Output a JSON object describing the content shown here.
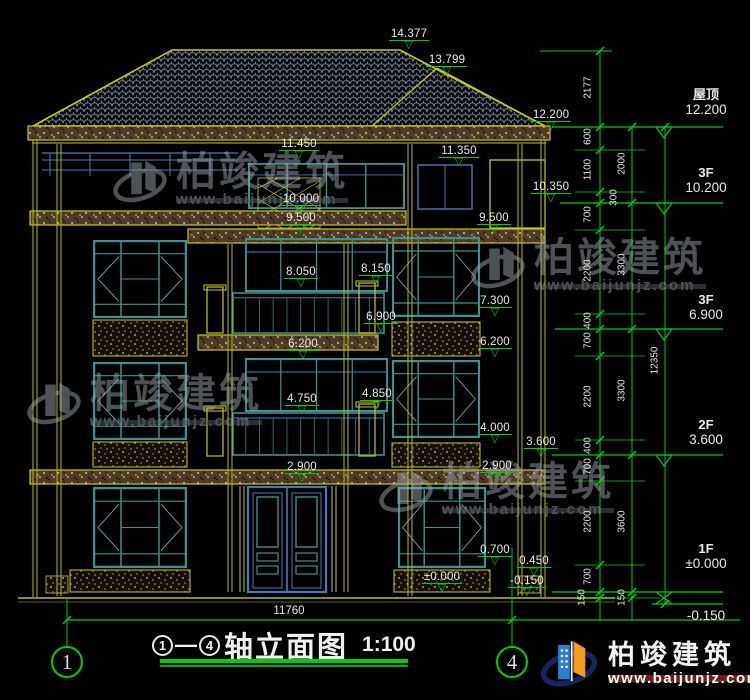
{
  "drawing": {
    "title": {
      "axis_from": "1",
      "axis_to": "4",
      "dash": "—",
      "name": "轴立面图",
      "scale": "1:100"
    },
    "bottom_width_dim": "11760",
    "axis_bubbles": [
      {
        "num": "1"
      },
      {
        "num": "4"
      }
    ],
    "levels": [
      {
        "value": "14.377"
      },
      {
        "value": "13.799"
      },
      {
        "value": "12.200"
      },
      {
        "value": "11.450"
      },
      {
        "value": "11.350"
      },
      {
        "value": "10.350"
      },
      {
        "value": "10.000"
      },
      {
        "value": "9.500"
      },
      {
        "value": "9.500"
      },
      {
        "value": "8.050"
      },
      {
        "value": "8.150"
      },
      {
        "value": "7.300"
      },
      {
        "value": "6.900"
      },
      {
        "value": "6.200"
      },
      {
        "value": "6.200"
      },
      {
        "value": "4.750"
      },
      {
        "value": "4.850"
      },
      {
        "value": "4.000"
      },
      {
        "value": "3.600"
      },
      {
        "value": "2.900"
      },
      {
        "value": "2.900"
      },
      {
        "value": "0.700"
      },
      {
        "value": "0.450"
      },
      {
        "value": "±0.000"
      },
      {
        "value": "-0.150"
      }
    ],
    "floors": [
      {
        "label": "屋顶",
        "value": "12.200"
      },
      {
        "label": "3F",
        "value": "10.200"
      },
      {
        "label": "3F",
        "value": "6.900"
      },
      {
        "label": "2F",
        "value": "3.600"
      },
      {
        "label": "1F",
        "value": "±0.000"
      },
      {
        "label": "",
        "value": "-0.150"
      }
    ],
    "dims": {
      "chain1": [
        "2177",
        "600",
        "1100",
        "300",
        "700",
        "2200",
        "400",
        "700",
        "2200",
        "400",
        "700",
        "2200",
        "700",
        "150"
      ],
      "chain2": [
        "2000",
        "3300",
        "3300",
        "3600",
        "150"
      ],
      "total": "12350"
    }
  },
  "brand": {
    "name": "柏竣建筑",
    "url": "www.baijunjz.com"
  },
  "colors": {
    "cad_green": "#00cc00",
    "cad_yellow": "#c6c62a",
    "window_teal": "#3f9090",
    "frame_blue": "#4a7ab5",
    "text_white": "#eaeaea",
    "brand_blue": "#2b7fd4",
    "brand_orange": "#f59b1e",
    "url_bar_red": "#701c1c"
  }
}
